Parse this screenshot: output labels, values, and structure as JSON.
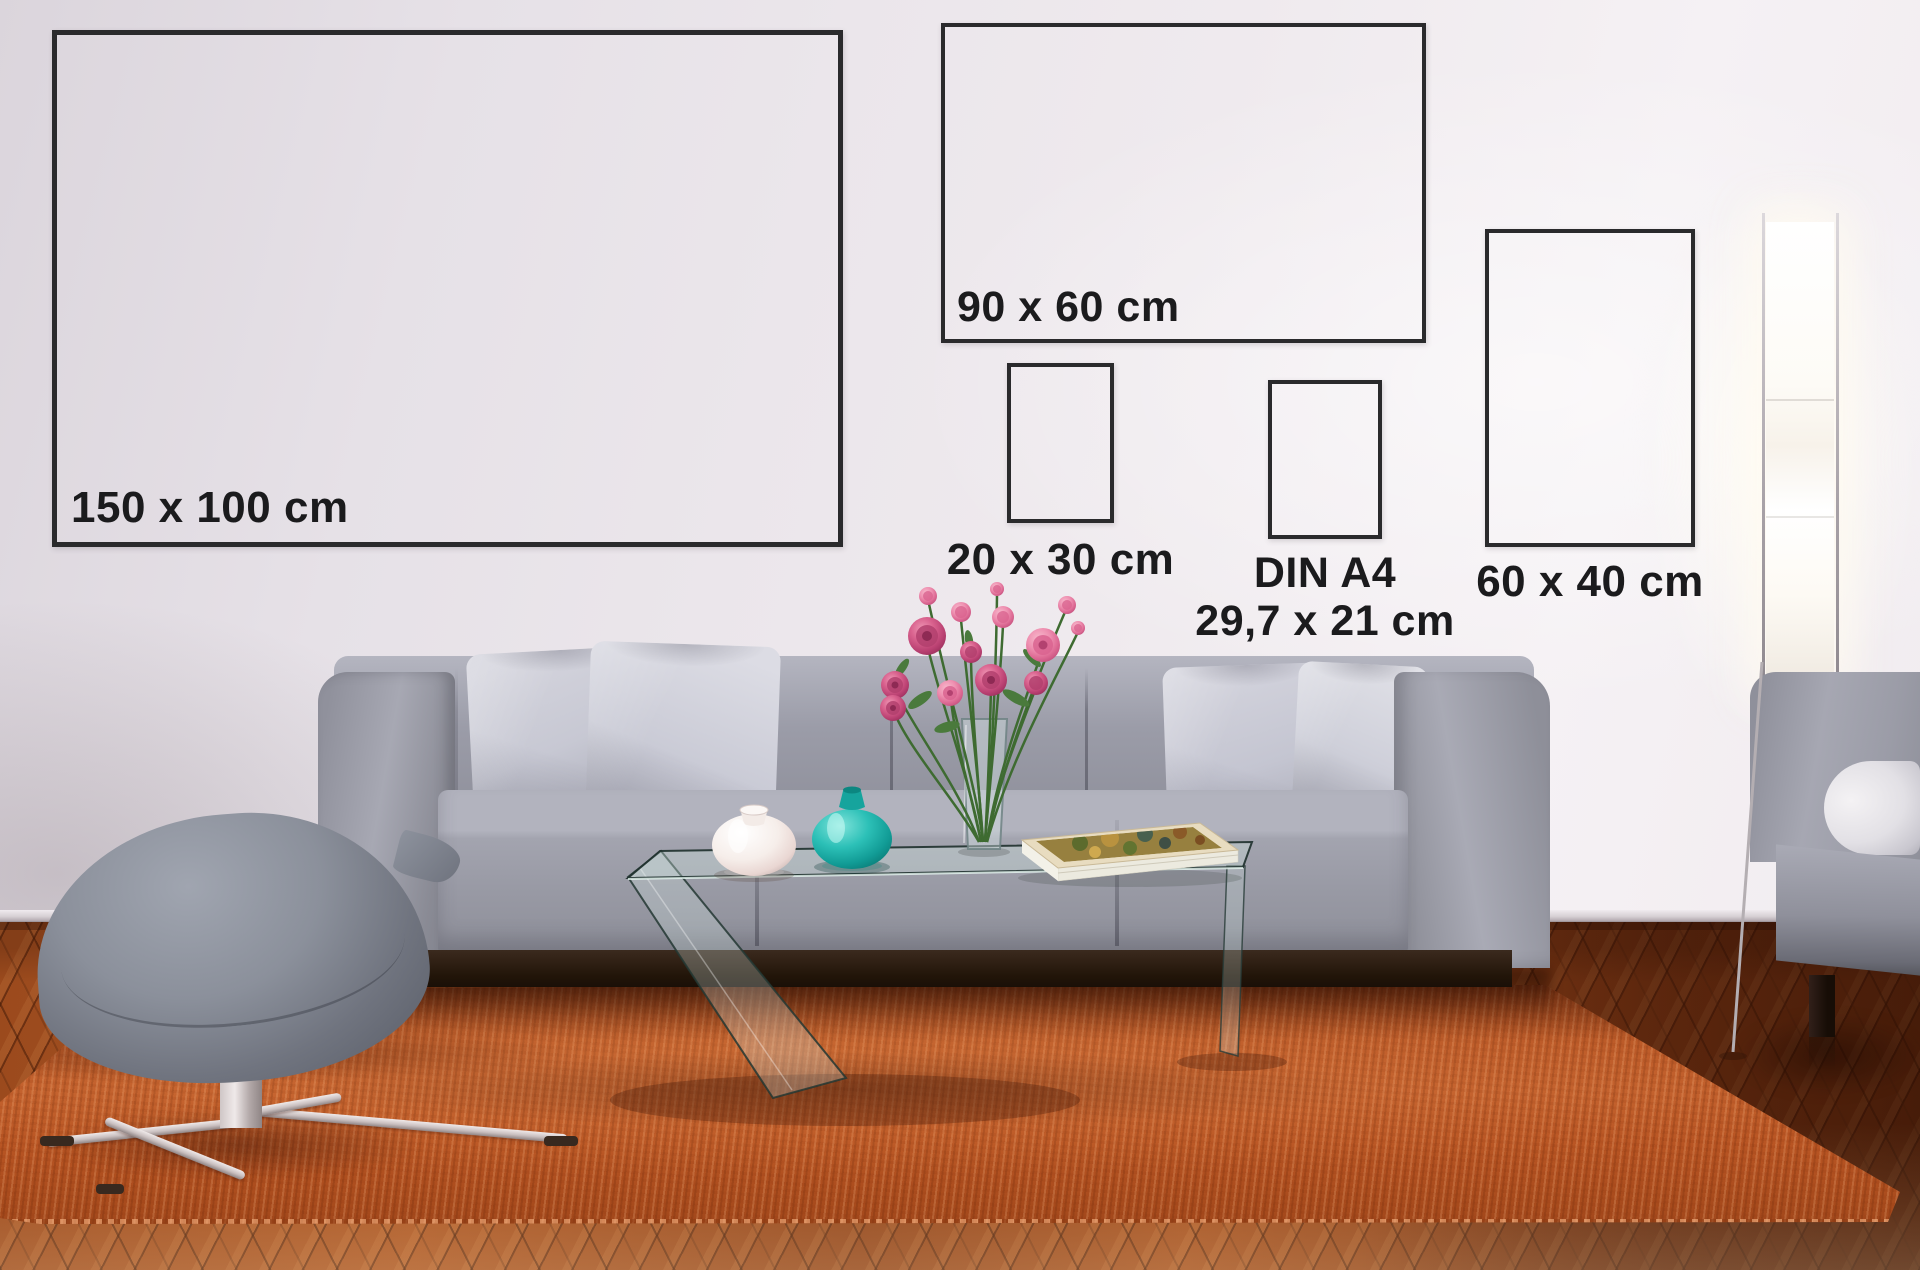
{
  "poster_sizes": [
    {
      "name": "150x100",
      "label": "150 x 100 cm"
    },
    {
      "name": "90x60",
      "label": "90 x 60 cm"
    },
    {
      "name": "20x30",
      "label": "20 x 30 cm"
    },
    {
      "name": "din-a4",
      "label": "DIN A4",
      "sublabel": "29,7 x 21 cm"
    },
    {
      "name": "60x40",
      "label": "60 x 40 cm"
    }
  ],
  "colors": {
    "frame_border": "#2a2a2c",
    "label_text": "#1b1b1d",
    "wall_light": "#f5f1f4",
    "wall_mid": "#eae5ea",
    "wall_dark": "#dcd7dd",
    "floor_light": "#b0602c",
    "floor_mid": "#96471d",
    "floor_dark": "#6b2c0f",
    "rug_light": "#c96f3b",
    "rug_mid": "#b04e20",
    "rug_dark": "#7e3412",
    "sofa_light": "#b4b5c0",
    "sofa_mid": "#9b9ca8",
    "sofa_dark": "#75767f",
    "pillow_mid": "#c7c8d3",
    "plinth_dark": "#2c1d13",
    "ottoman_gray": "#8b909b",
    "chrome": "#cdc5c5",
    "teal_vase": "#1cbcb3",
    "white_vase": "#f7f1ee",
    "flower_pink": "#ec89ab",
    "flower_deep": "#c34e79",
    "stem_green": "#41702f",
    "glass_tint": "#b9d4cd",
    "lamp_glow": "#fffdf8"
  }
}
